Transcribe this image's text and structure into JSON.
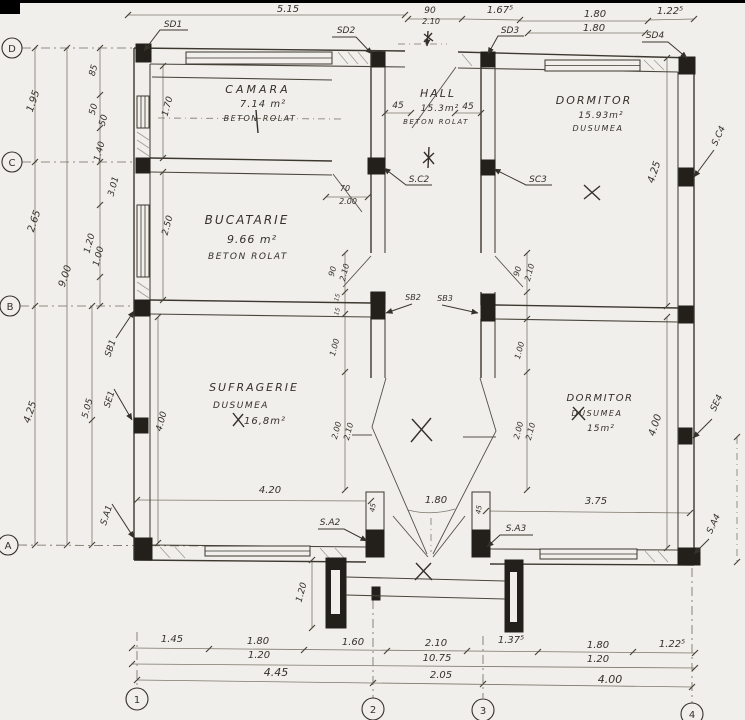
{
  "palette": {
    "paper": "#f0efeb",
    "ink": "#35302a",
    "column_fill": "#23201b",
    "dim_line": "#7d766b"
  },
  "grid": {
    "rows": [
      "D",
      "C",
      "B",
      "A"
    ],
    "cols": [
      "1",
      "2",
      "3",
      "4"
    ]
  },
  "rooms": [
    {
      "name": "CAMARA",
      "area": "7.14 m²",
      "floor": "BETON ROLAT"
    },
    {
      "name": "HALL",
      "area": "15.3m²",
      "floor": "BETON ROLAT"
    },
    {
      "name": "DORMITOR",
      "area": "15.93m²",
      "floor": "DUSUMEA"
    },
    {
      "name": "BUCATARIE",
      "area": "9.66 m²",
      "floor": "BETON ROLAT"
    },
    {
      "name": "SUFRAGERIE",
      "area": "16,8m²",
      "floor": "DUSUMEA"
    },
    {
      "name": "DORMITOR",
      "area": "15m²",
      "floor": "DUSUMEA"
    }
  ],
  "annotations": [
    {
      "t": "5.15",
      "x": 288,
      "y": 12,
      "s": 10
    },
    {
      "t": "90",
      "x": 430,
      "y": 13,
      "s": 9
    },
    {
      "t": "2.10",
      "x": 431,
      "y": 24,
      "s": 8
    },
    {
      "t": "1.67⁵",
      "x": 500,
      "y": 13,
      "s": 10
    },
    {
      "t": "1.80",
      "x": 595,
      "y": 17,
      "s": 10
    },
    {
      "t": "1.80",
      "x": 594,
      "y": 31,
      "s": 10
    },
    {
      "t": "1.22⁵",
      "x": 670,
      "y": 14,
      "s": 10
    },
    {
      "t": "SD1",
      "x": 173,
      "y": 27,
      "s": 9
    },
    {
      "t": "SD2",
      "x": 346,
      "y": 33,
      "s": 9
    },
    {
      "t": "SD3",
      "x": 510,
      "y": 33,
      "s": 9
    },
    {
      "t": "SD4",
      "x": 655,
      "y": 38,
      "s": 9
    },
    {
      "t": "1.95",
      "x": 36,
      "y": 102,
      "r": -72,
      "s": 10
    },
    {
      "t": "85",
      "x": 96,
      "y": 71,
      "r": -75,
      "s": 9
    },
    {
      "t": "50",
      "x": 96,
      "y": 110,
      "r": -75,
      "s": 9
    },
    {
      "t": "50",
      "x": 106,
      "y": 121,
      "r": -75,
      "s": 9
    },
    {
      "t": "1.40",
      "x": 102,
      "y": 152,
      "r": -75,
      "s": 9
    },
    {
      "t": "3.01",
      "x": 116,
      "y": 187,
      "r": -75,
      "s": 9
    },
    {
      "t": "2.65",
      "x": 37,
      "y": 222,
      "r": -72,
      "s": 10
    },
    {
      "t": "1.20",
      "x": 92,
      "y": 244,
      "r": -75,
      "s": 9
    },
    {
      "t": "1.00",
      "x": 101,
      "y": 257,
      "r": -75,
      "s": 9
    },
    {
      "t": "9.00",
      "x": 68,
      "y": 277,
      "r": -72,
      "s": 10
    },
    {
      "t": "4.25",
      "x": 33,
      "y": 413,
      "r": -72,
      "s": 10
    },
    {
      "t": "5.05",
      "x": 90,
      "y": 409,
      "r": -75,
      "s": 9
    },
    {
      "t": "SB1",
      "x": 113,
      "y": 349,
      "r": -72,
      "s": 9
    },
    {
      "t": "SE1",
      "x": 112,
      "y": 400,
      "r": -72,
      "s": 9
    },
    {
      "t": "S.A1",
      "x": 109,
      "y": 516,
      "r": -72,
      "s": 9
    },
    {
      "t": "1.70",
      "x": 170,
      "y": 107,
      "r": -75,
      "s": 9
    },
    {
      "t": "2.50",
      "x": 170,
      "y": 226,
      "r": -75,
      "s": 9
    },
    {
      "t": "4.00",
      "x": 164,
      "y": 422,
      "r": -75,
      "s": 9
    },
    {
      "t": "70",
      "x": 345,
      "y": 191,
      "s": 8
    },
    {
      "t": "2.00",
      "x": 348,
      "y": 204,
      "s": 8
    },
    {
      "t": "45",
      "x": 398,
      "y": 108,
      "s": 9
    },
    {
      "t": "45",
      "x": 468,
      "y": 109,
      "s": 9
    },
    {
      "t": "90",
      "x": 335,
      "y": 272,
      "r": -75,
      "s": 8
    },
    {
      "t": "2.10",
      "x": 347,
      "y": 273,
      "r": -75,
      "s": 8
    },
    {
      "t": "90",
      "x": 520,
      "y": 272,
      "r": -75,
      "s": 8
    },
    {
      "t": "2.10",
      "x": 532,
      "y": 273,
      "r": -75,
      "s": 8
    },
    {
      "t": "15",
      "x": 339,
      "y": 298,
      "r": -75,
      "s": 6
    },
    {
      "t": "15",
      "x": 339,
      "y": 312,
      "r": -75,
      "s": 6
    },
    {
      "t": "1.00",
      "x": 337,
      "y": 348,
      "r": -75,
      "s": 8
    },
    {
      "t": "1.00",
      "x": 522,
      "y": 351,
      "r": -75,
      "s": 8
    },
    {
      "t": "2.00",
      "x": 339,
      "y": 431,
      "r": -75,
      "s": 8
    },
    {
      "t": "2.10",
      "x": 351,
      "y": 432,
      "r": -75,
      "s": 8
    },
    {
      "t": "2.00",
      "x": 521,
      "y": 431,
      "r": -75,
      "s": 8
    },
    {
      "t": "2.10",
      "x": 533,
      "y": 432,
      "r": -75,
      "s": 8
    },
    {
      "t": "SB2",
      "x": 413,
      "y": 300,
      "s": 8
    },
    {
      "t": "SB3",
      "x": 445,
      "y": 301,
      "s": 8
    },
    {
      "t": "S.C2",
      "x": 419,
      "y": 182,
      "s": 9
    },
    {
      "t": "SC3",
      "x": 538,
      "y": 182,
      "s": 9
    },
    {
      "t": "4.20",
      "x": 270,
      "y": 493,
      "s": 10
    },
    {
      "t": "1.80",
      "x": 436,
      "y": 503,
      "s": 10
    },
    {
      "t": "3.75",
      "x": 596,
      "y": 504,
      "s": 10
    },
    {
      "t": "45",
      "x": 375,
      "y": 508,
      "r": -80,
      "s": 7
    },
    {
      "t": "45",
      "x": 481,
      "y": 510,
      "r": -80,
      "s": 7
    },
    {
      "t": "S.A2",
      "x": 330,
      "y": 525,
      "s": 9
    },
    {
      "t": "S.A3",
      "x": 516,
      "y": 531,
      "s": 9
    },
    {
      "t": "4.25",
      "x": 657,
      "y": 173,
      "r": -72,
      "s": 10
    },
    {
      "t": "S.C4",
      "x": 721,
      "y": 137,
      "r": -65,
      "s": 9
    },
    {
      "t": "4.00",
      "x": 658,
      "y": 426,
      "r": -72,
      "s": 10
    },
    {
      "t": "SE4",
      "x": 719,
      "y": 404,
      "r": -65,
      "s": 9
    },
    {
      "t": "S.A4",
      "x": 716,
      "y": 525,
      "r": -65,
      "s": 9
    },
    {
      "t": "1.20",
      "x": 304,
      "y": 593,
      "r": -75,
      "s": 9
    },
    {
      "t": "1.45",
      "x": 172,
      "y": 642,
      "s": 10
    },
    {
      "t": "1.80",
      "x": 258,
      "y": 644,
      "s": 10
    },
    {
      "t": "1.20",
      "x": 259,
      "y": 658,
      "s": 10
    },
    {
      "t": "1.60",
      "x": 353,
      "y": 645,
      "s": 10
    },
    {
      "t": "2.10",
      "x": 436,
      "y": 646,
      "s": 10
    },
    {
      "t": "1.37⁵",
      "x": 511,
      "y": 643,
      "s": 10
    },
    {
      "t": "1.80",
      "x": 598,
      "y": 648,
      "s": 10
    },
    {
      "t": "1.20",
      "x": 598,
      "y": 662,
      "s": 10
    },
    {
      "t": "1.22⁵",
      "x": 672,
      "y": 647,
      "s": 10
    },
    {
      "t": "10.75",
      "x": 437,
      "y": 661,
      "s": 10
    },
    {
      "t": "4.45",
      "x": 276,
      "y": 676,
      "s": 11
    },
    {
      "t": "2.05",
      "x": 441,
      "y": 678,
      "s": 10
    },
    {
      "t": "4.00",
      "x": 610,
      "y": 683,
      "s": 11
    }
  ]
}
